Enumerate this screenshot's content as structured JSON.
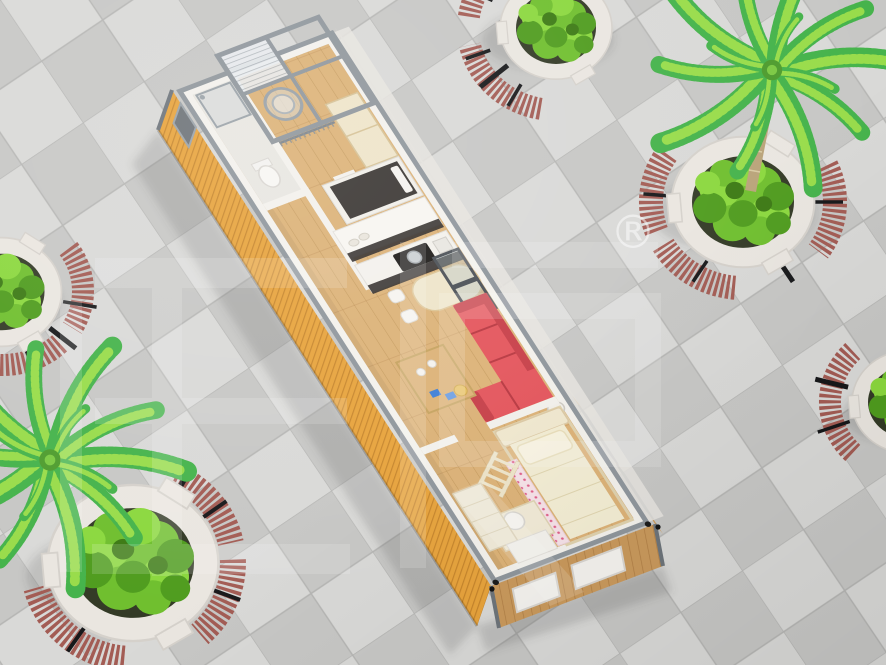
{
  "page": {
    "title": "Container house floor plan 3D render on tiled plaza"
  },
  "watermark": {
    "registered_symbol": "®",
    "style": "translucent white stylized CJK logo glyphs"
  },
  "scene": {
    "setting": "aerial three-quarter view of a gray checkered tile plaza",
    "building": {
      "kind": "single flat-pack container house, roof removed (cutaway top view)",
      "exterior_siding": "orange corrugated steel on left wall, wood panelling on ends",
      "areas": [
        "pergola-porch",
        "bathroom",
        "hanging-chair-balcony",
        "wardrobe",
        "single-bed-nook",
        "kitchen",
        "bar-dining",
        "living-room",
        "kids-bedroom"
      ],
      "furniture": [
        "glass shower",
        "toilet",
        "hanging egg chair",
        "tall wardrobe",
        "dark single bed",
        "kitchen counter with cooktop and pot",
        "bar table with two stools",
        "leaning window panels",
        "red L-shaped sofa",
        "wood coffee table",
        "loft bed with ladder and pink dotted curtain",
        "desk with chair",
        "dresser"
      ]
    },
    "landscaping": {
      "planter_count": 5,
      "palm_tree_count": 2,
      "planter_style": "round white concrete planters with green shrubs",
      "bench_style": "curved red-brown slatted benches with black metal legs"
    }
  },
  "colors": {
    "tile-light": "#d9d9d7",
    "tile-dark": "#c7c7c5",
    "grout": "#b5b5b3",
    "container-orange": "#e7a33c",
    "corrugation-shadow": "#c5832a",
    "frame-gray": "#8f969c",
    "wall-white": "#f3f1ec",
    "wall-inner-gray": "#e8e6e1",
    "floor-wood": "#dcb277",
    "plank-line": "#c49a5d",
    "end-wood": "#c9995c",
    "sofa-red": "#e4555c",
    "sofa-red-dark": "#c73f48",
    "bench-wood": "#a35c54",
    "bench-metal": "#17181a",
    "planter-white": "#eae6e0",
    "soil-dark": "#333a26",
    "bush-green": "#6fbf2e",
    "bush-green-light": "#8bd83e",
    "bush-green-dark": "#4f9c1e",
    "palm-green": "#45b34b",
    "palm-green-light": "#98dc4a",
    "trunk-brown": "#b9a379",
    "cream": "#eee4c9",
    "bed-cream": "#f3edd3",
    "pink-fabric": "#f6e2e8",
    "pink-dot": "#e0608a",
    "cabinet-dark": "#322e2b",
    "window-frame": "#4b5056",
    "glass": "#c7d3d8",
    "watermark": "#ffffff"
  }
}
